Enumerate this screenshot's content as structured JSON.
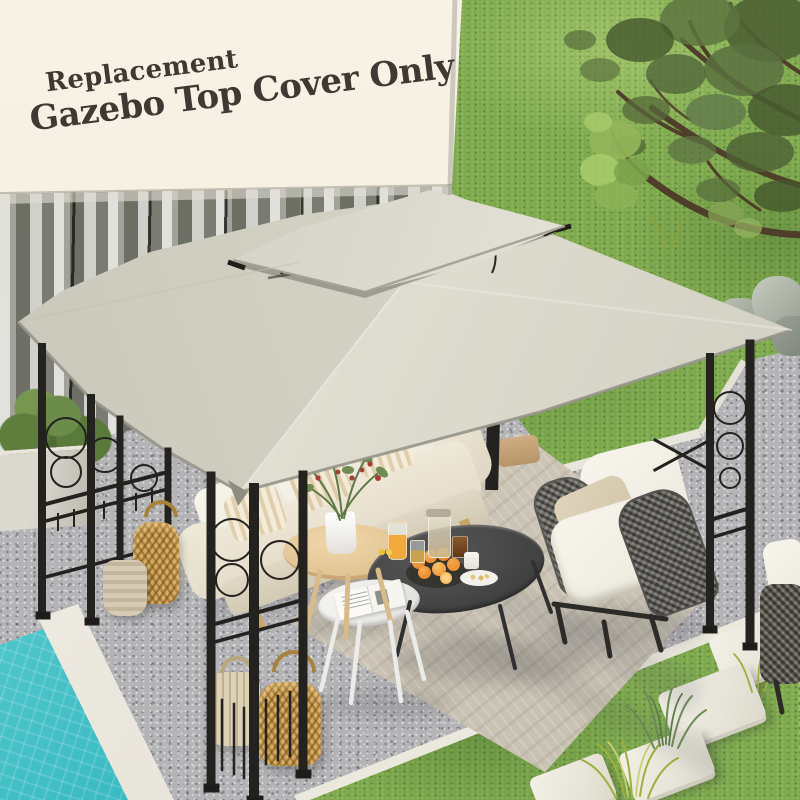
{
  "overlay_text": {
    "line1": "Replacement",
    "line2": "Gazebo Top Cover Only",
    "color": "#3E3933"
  },
  "product": {
    "name": "two-tier gazebo replacement top cover",
    "canopy_color": "#D9D7CA",
    "frame_color": "#26251F"
  },
  "scene": {
    "environment": [
      "cream house wall",
      "glass wall with sheer curtains",
      "green lawn",
      "olive tree",
      "gravel patio",
      "woven area rug",
      "turquoise swimming pool",
      "stepping stones",
      "boxwood in concrete planter",
      "landscape rocks"
    ],
    "furniture": [
      "cream outdoor sofa with striped pillows",
      "rope-weave lounge chair with white cushions",
      "black oval coffee table",
      "white round nesting table",
      "light wood round side table",
      "rattan lanterns"
    ],
    "props": [
      "plate of oranges",
      "orange juice",
      "glass jar",
      "white mug",
      "snack plate",
      "open magazine",
      "potted red-berry plant"
    ]
  },
  "palette": {
    "wall_cream": "#F6F0E3",
    "grass_green": "#7DA94C",
    "gravel_gray": "#B4B3B6",
    "rug_beige": "#CEC7B9",
    "pool_turquoise": "#3BBFC7",
    "wicker_gold": "#C79B52",
    "wood_light": "#E5C99D",
    "table_charcoal": "#454545",
    "cushion_white": "#F3EFE6",
    "canopy_greige": "#D9D7CA"
  }
}
